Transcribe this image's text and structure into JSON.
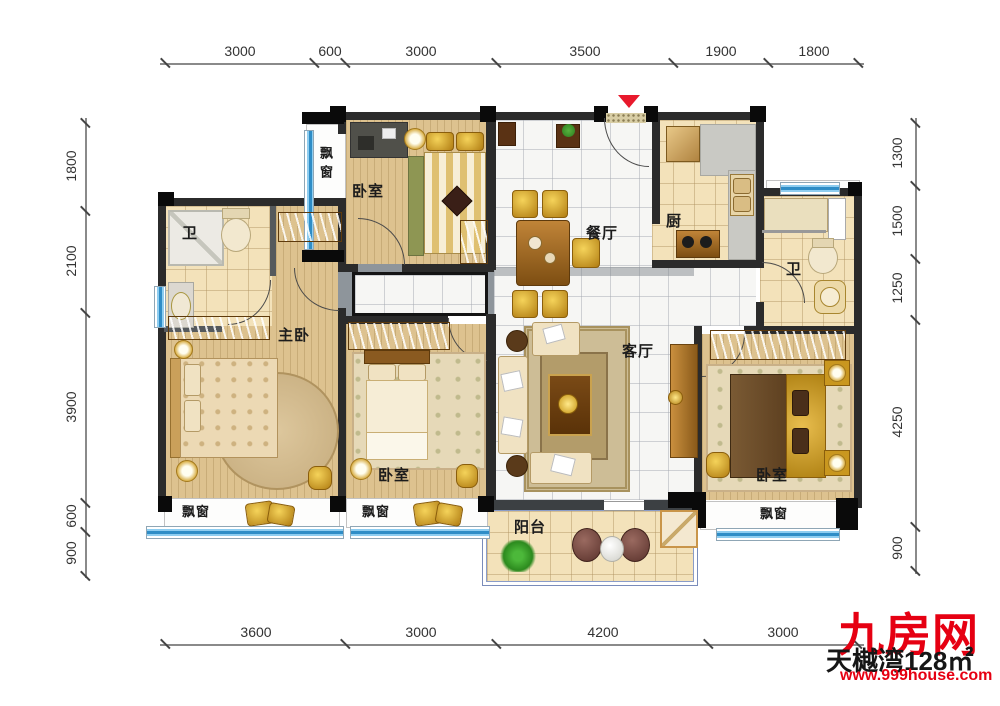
{
  "plan_labels": {
    "bedroom": "卧室",
    "master_bedroom": "主卧",
    "living_room": "客厅",
    "dining_room": "餐厅",
    "kitchen": "厨",
    "bathroom": "卫",
    "balcony": "阳台",
    "bay_window": "飘窗"
  },
  "dimensions": {
    "top": [
      "3000",
      "600",
      "3000",
      "3500",
      "1900",
      "1800"
    ],
    "bottom": [
      "3600",
      "3000",
      "4200",
      "3000"
    ],
    "left": [
      "1800",
      "2100",
      "3900",
      "600",
      "900"
    ],
    "right": [
      "1300",
      "1500",
      "1250",
      "4250",
      "900"
    ]
  },
  "watermark": {
    "site_name": "九房网",
    "site_url": "www.999house.com",
    "project_text": "天樾湾128㎡"
  },
  "colors": {
    "entry_arrow": "#e8192c",
    "watermark_red": "#e60012",
    "window_blue": "#2f8dc6",
    "wall_dark": "#2b2b2b"
  }
}
